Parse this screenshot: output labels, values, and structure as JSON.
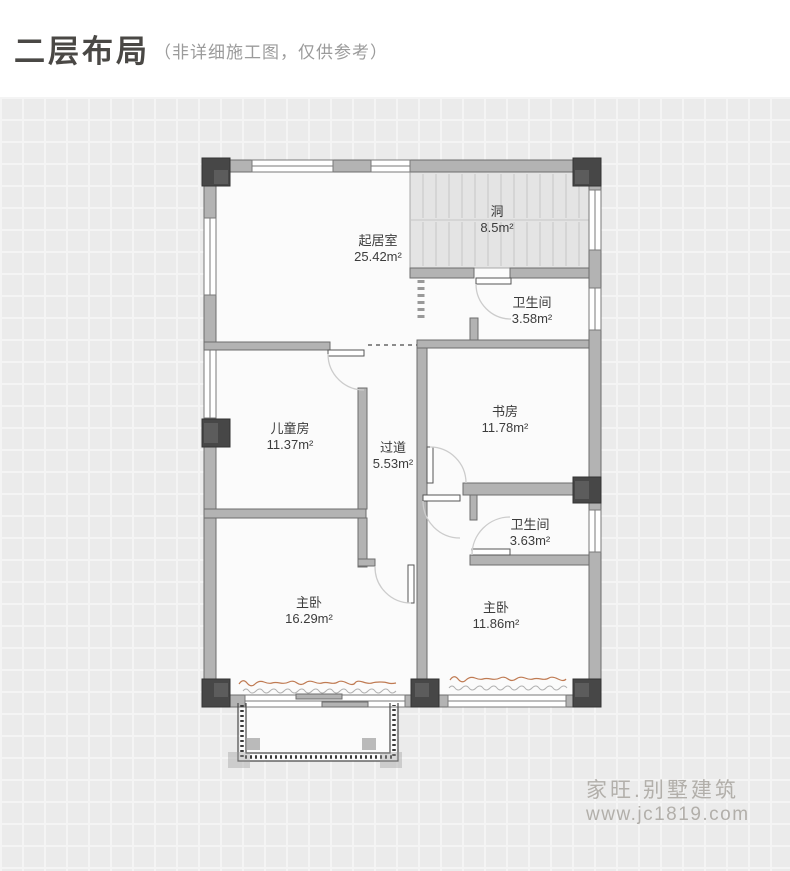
{
  "header": {
    "title": "二层布局",
    "subtitle": "（非详细施工图，仅供参考）"
  },
  "floor_plan": {
    "rooms": [
      {
        "name": "起居室",
        "area": "25.42m²",
        "x": 378,
        "y": 249
      },
      {
        "name": "洞",
        "area": "8.5m²",
        "x": 497,
        "y": 220
      },
      {
        "name": "卫生间",
        "area": "3.58m²",
        "x": 532,
        "y": 311
      },
      {
        "name": "儿童房",
        "area": "11.37m²",
        "x": 290,
        "y": 437
      },
      {
        "name": "书房",
        "area": "11.78m²",
        "x": 505,
        "y": 420
      },
      {
        "name": "过道",
        "area": "5.53m²",
        "x": 393,
        "y": 456
      },
      {
        "name": "卫生间",
        "area": "3.63m²",
        "x": 530,
        "y": 533
      },
      {
        "name": "主卧",
        "area": "16.29m²",
        "x": 309,
        "y": 611
      },
      {
        "name": "主卧",
        "area": "11.86m²",
        "x": 496,
        "y": 616
      }
    ]
  },
  "watermark": {
    "brand": "家旺.别墅建筑",
    "url": "www.jc1819.com"
  },
  "colors": {
    "wall": "#b3b3b3",
    "wall_border": "#6e6e6e",
    "column": "#474747",
    "stairs_fill": "#e4e4e4",
    "room_fill": "#fbfbfb",
    "plant": "#bf7a52",
    "label_text": "#3c3c3c",
    "title_text": "#4a4845",
    "subtitle_text": "#9b9b9b",
    "watermark_text": "#b2afaa"
  }
}
